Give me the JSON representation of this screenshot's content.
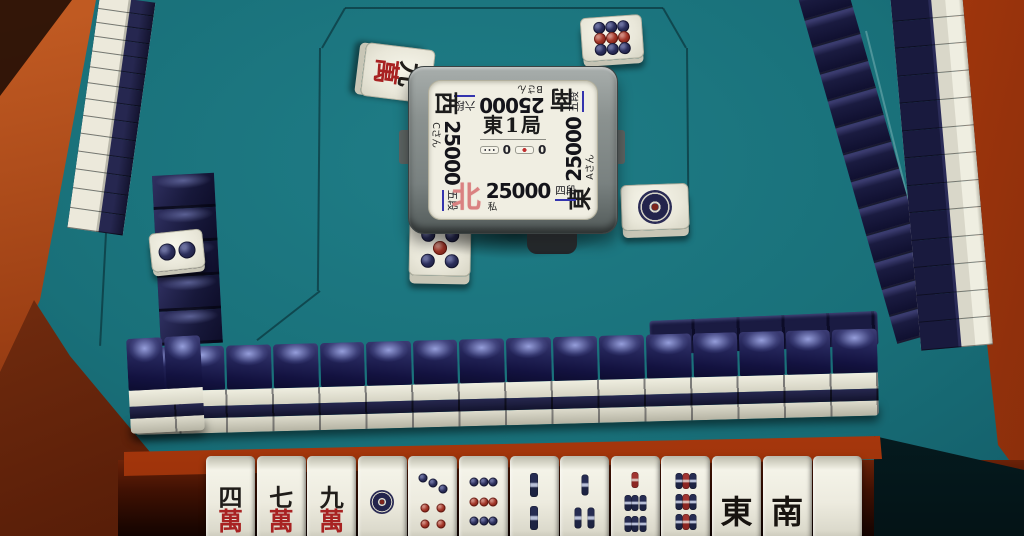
{
  "center_display": {
    "round": "東1局",
    "honba": {
      "count": "0"
    },
    "riichi": {
      "count": "0"
    },
    "players": {
      "self": {
        "wind": "北",
        "score": "25000",
        "rank": "四段",
        "name": "私"
      },
      "right": {
        "wind": "東",
        "score": "25000",
        "rank": "五段",
        "name": "Aさん"
      },
      "top": {
        "wind": "南",
        "score": "25000",
        "rank": "六段",
        "name": "Bさん"
      },
      "left": {
        "wind": "西",
        "score": "25000",
        "rank": "五段",
        "name": "Cさん"
      }
    }
  },
  "hand": {
    "tiles": [
      {
        "id": "man4",
        "label": "四萬"
      },
      {
        "id": "man7",
        "label": "七萬"
      },
      {
        "id": "man9",
        "label": "九萬"
      },
      {
        "id": "pin1",
        "label": "一筒"
      },
      {
        "id": "pin7",
        "label": "七筒"
      },
      {
        "id": "pin9",
        "label": "九筒"
      },
      {
        "id": "sou2",
        "label": "二索"
      },
      {
        "id": "sou3",
        "label": "三索"
      },
      {
        "id": "sou7",
        "label": "七索"
      },
      {
        "id": "sou9",
        "label": "九索"
      },
      {
        "id": "east",
        "label": "東"
      },
      {
        "id": "south",
        "label": "南"
      },
      {
        "id": "haku",
        "label": "白"
      }
    ]
  },
  "discards": [
    {
      "position": "top-left",
      "tile": "man9",
      "label": "九萬"
    },
    {
      "position": "top-right",
      "tile": "pin9",
      "label": "九筒"
    },
    {
      "position": "right",
      "tile": "pin1",
      "label": "一筒"
    },
    {
      "position": "bottom-center",
      "tile": "pin5",
      "label": "五筒"
    }
  ],
  "dora_indicator": {
    "tile": "pin2",
    "label": "二筒"
  },
  "walls": {
    "left_outer": {
      "count": 14
    },
    "left_inner": {
      "count": 5
    },
    "right_inner": {
      "count": 13
    },
    "right_outer": {
      "count": 13
    },
    "bottom": {
      "count": 16
    },
    "bottom_corner": {
      "count": 2
    }
  },
  "tiles": {
    "man4": {
      "type": "man",
      "num": "四",
      "suit": "萬"
    },
    "man7": {
      "type": "man",
      "num": "七",
      "suit": "萬"
    },
    "man9": {
      "type": "man",
      "num": "九",
      "suit": "萬"
    },
    "pin1": {
      "type": "pin",
      "dot_size": 58,
      "dots": [
        [
          50,
          50,
          "big"
        ]
      ]
    },
    "pin2": {
      "type": "pin",
      "dot_size": 38,
      "dots": [
        [
          50,
          28,
          "navy"
        ],
        [
          50,
          72,
          "navy"
        ]
      ]
    },
    "pin5": {
      "type": "pin",
      "dot_size": 27,
      "dots": [
        [
          27,
          24,
          "navy"
        ],
        [
          73,
          24,
          "navy"
        ],
        [
          50,
          50,
          "red"
        ],
        [
          27,
          76,
          "navy"
        ],
        [
          73,
          76,
          "navy"
        ]
      ]
    },
    "pin7": {
      "type": "pin",
      "dot_size": 23,
      "dots": [
        [
          25,
          15,
          "navy"
        ],
        [
          50,
          23,
          "navy"
        ],
        [
          75,
          31,
          "navy"
        ],
        [
          31,
          60,
          "red"
        ],
        [
          69,
          60,
          "red"
        ],
        [
          31,
          84,
          "red"
        ],
        [
          69,
          84,
          "red"
        ]
      ]
    },
    "pin9": {
      "type": "pin",
      "dot_size": 23,
      "dots": [
        [
          26,
          21,
          "navy"
        ],
        [
          50,
          21,
          "navy"
        ],
        [
          74,
          21,
          "navy"
        ],
        [
          26,
          50,
          "red"
        ],
        [
          50,
          50,
          "red"
        ],
        [
          74,
          50,
          "red"
        ],
        [
          26,
          79,
          "navy"
        ],
        [
          50,
          79,
          "navy"
        ],
        [
          74,
          79,
          "navy"
        ]
      ]
    },
    "sou2": {
      "type": "sou",
      "stick": [
        20,
        36
      ],
      "sticks": [
        [
          50,
          26,
          "navy"
        ],
        [
          50,
          74,
          "navy"
        ]
      ]
    },
    "sou3": {
      "type": "sou",
      "stick": [
        18,
        32
      ],
      "sticks": [
        [
          50,
          25,
          "navy"
        ],
        [
          34,
          74,
          "navy"
        ],
        [
          66,
          74,
          "navy"
        ]
      ]
    },
    "sou7": {
      "type": "sou",
      "stick": [
        16,
        24
      ],
      "sticks": [
        [
          50,
          18,
          "red"
        ],
        [
          32,
          52,
          "navy"
        ],
        [
          50,
          52,
          "navy"
        ],
        [
          68,
          52,
          "navy"
        ],
        [
          32,
          83,
          "navy"
        ],
        [
          50,
          83,
          "navy"
        ],
        [
          68,
          83,
          "navy"
        ]
      ]
    },
    "sou9": {
      "type": "sou",
      "stick": [
        16,
        24
      ],
      "sticks": [
        [
          32,
          20,
          "navy"
        ],
        [
          50,
          20,
          "red"
        ],
        [
          68,
          20,
          "navy"
        ],
        [
          32,
          50,
          "navy"
        ],
        [
          50,
          50,
          "red"
        ],
        [
          68,
          50,
          "navy"
        ],
        [
          32,
          80,
          "navy"
        ],
        [
          50,
          80,
          "red"
        ],
        [
          68,
          80,
          "navy"
        ]
      ]
    },
    "east": {
      "type": "honor",
      "char": "東"
    },
    "south": {
      "type": "honor",
      "char": "南"
    },
    "haku": {
      "type": "blank"
    }
  },
  "palette": {
    "felt": "#17656f",
    "tile_back": "#181a3e",
    "tile_face": "#edebdd",
    "frame_orange": "#c2440f",
    "self_wind_red": "#da8181",
    "rank_underline": "#3434ae",
    "dot_navy": "#23254e",
    "dot_red": "#9e2e26"
  }
}
